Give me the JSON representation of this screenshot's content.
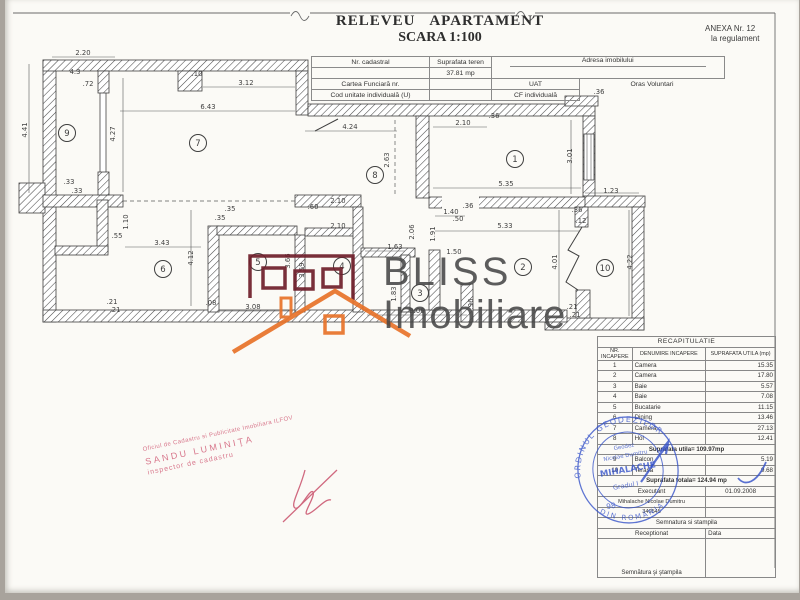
{
  "header": {
    "title1": "RELEVEU APARTAMENT",
    "title2": "SCARA 1:100",
    "anexa1": "ANEXA Nr. 12",
    "anexa2": "la regulament"
  },
  "info_table": {
    "nr_cadastral": "Nr. cadastral",
    "suprafata_teren": "Suprafata teren",
    "teren_value": "37.81 mp",
    "adresa": "Adresa imobilului",
    "cartea": "Cartea Funciară nr.",
    "uat_label": "UAT",
    "uat_value": "Oras Voluntari",
    "cod": "Cod unitate individuală (U)",
    "cf": "CF individuală"
  },
  "watermark": {
    "brand1": "BLISS",
    "brand2": "Imobiliare"
  },
  "plan": {
    "scale_note": "1:100",
    "rooms": [
      {
        "n": "1",
        "x": 510,
        "y": 159
      },
      {
        "n": "2",
        "x": 518,
        "y": 267
      },
      {
        "n": "3",
        "x": 415,
        "y": 293
      },
      {
        "n": "4",
        "x": 337,
        "y": 266
      },
      {
        "n": "5",
        "x": 253,
        "y": 262
      },
      {
        "n": "6",
        "x": 158,
        "y": 269
      },
      {
        "n": "7",
        "x": 193,
        "y": 143
      },
      {
        "n": "8",
        "x": 370,
        "y": 175
      },
      {
        "n": "9",
        "x": 62,
        "y": 133
      },
      {
        "n": "10",
        "x": 600,
        "y": 268
      }
    ],
    "dims": [
      {
        "t": "2.20",
        "x": 78,
        "y": 55
      },
      {
        "t": "4.3",
        "x": 70,
        "y": 74
      },
      {
        "t": ".72",
        "x": 83,
        "y": 86
      },
      {
        "t": "4.41",
        "x": 22,
        "y": 130,
        "v": 1
      },
      {
        "t": "4.27",
        "x": 110,
        "y": 134,
        "v": 1
      },
      {
        "t": "3.12",
        "x": 241,
        "y": 85
      },
      {
        "t": "6.43",
        "x": 203,
        "y": 109
      },
      {
        "t": ".10",
        "x": 192,
        "y": 76
      },
      {
        "t": ".33",
        "x": 64,
        "y": 184
      },
      {
        "t": ".33",
        "x": 72,
        "y": 193
      },
      {
        "t": "4.24",
        "x": 345,
        "y": 129
      },
      {
        "t": "2.63",
        "x": 384,
        "y": 160,
        "v": 1
      },
      {
        "t": "2.10",
        "x": 458,
        "y": 125
      },
      {
        "t": ".36",
        "x": 489,
        "y": 118
      },
      {
        "t": ".36",
        "x": 594,
        "y": 94
      },
      {
        "t": "5.35",
        "x": 501,
        "y": 186
      },
      {
        "t": "3.01",
        "x": 567,
        "y": 156,
        "v": 1
      },
      {
        "t": "1.23",
        "x": 606,
        "y": 193
      },
      {
        "t": ".36",
        "x": 572,
        "y": 212
      },
      {
        "t": ".12",
        "x": 576,
        "y": 223
      },
      {
        "t": "4.01",
        "x": 552,
        "y": 262,
        "v": 1
      },
      {
        "t": "4.22",
        "x": 627,
        "y": 262,
        "v": 1
      },
      {
        "t": "1.40",
        "x": 446,
        "y": 214
      },
      {
        "t": ".36",
        "x": 463,
        "y": 208
      },
      {
        "t": ".50",
        "x": 453,
        "y": 221
      },
      {
        "t": "5.33",
        "x": 500,
        "y": 228
      },
      {
        "t": "2.10",
        "x": 333,
        "y": 203
      },
      {
        "t": ".60",
        "x": 308,
        "y": 209
      },
      {
        "t": "2.10",
        "x": 333,
        "y": 228
      },
      {
        "t": ".35",
        "x": 225,
        "y": 211
      },
      {
        "t": ".35",
        "x": 215,
        "y": 220
      },
      {
        "t": "1.10",
        "x": 123,
        "y": 222,
        "v": 1
      },
      {
        "t": ".55",
        "x": 112,
        "y": 238
      },
      {
        "t": "3.43",
        "x": 157,
        "y": 245
      },
      {
        "t": "4.12",
        "x": 188,
        "y": 258,
        "v": 1
      },
      {
        "t": "1.63",
        "x": 390,
        "y": 249
      },
      {
        "t": "2.06",
        "x": 409,
        "y": 232,
        "v": 1
      },
      {
        "t": "1.91",
        "x": 430,
        "y": 234,
        "v": 1
      },
      {
        "t": "1.50",
        "x": 449,
        "y": 254
      },
      {
        "t": "1.83",
        "x": 391,
        "y": 294,
        "v": 1
      },
      {
        "t": "3.66",
        "x": 285,
        "y": 261,
        "v": 1
      },
      {
        "t": "3.59",
        "x": 299,
        "y": 270,
        "v": 1
      },
      {
        "t": "3.06",
        "x": 412,
        "y": 313
      },
      {
        "t": ".96",
        "x": 468,
        "y": 304,
        "v": 1
      },
      {
        "t": "3.08",
        "x": 248,
        "y": 309
      },
      {
        "t": ".08",
        "x": 206,
        "y": 305
      },
      {
        "t": ".21",
        "x": 107,
        "y": 304
      },
      {
        "t": ".21",
        "x": 110,
        "y": 312
      },
      {
        "t": ".21",
        "x": 567,
        "y": 309
      },
      {
        "t": ".21",
        "x": 570,
        "y": 317
      }
    ]
  },
  "recap": {
    "title": "RECAPITULATIE",
    "col_nr": "NR. INCAPERE",
    "col_den": "DENUMIRE INCAPERE",
    "col_sup": "SUPRAFATA UTILA (mp)",
    "rows": [
      {
        "nr": "1",
        "den": "Camera",
        "sup": "15.35"
      },
      {
        "nr": "2",
        "den": "Camera",
        "sup": "17.80"
      },
      {
        "nr": "3",
        "den": "Baie",
        "sup": "5.57"
      },
      {
        "nr": "4",
        "den": "Baie",
        "sup": "7.08"
      },
      {
        "nr": "5",
        "den": "Bucatarie",
        "sup": "11.15"
      },
      {
        "nr": "6",
        "den": "Dining",
        "sup": "13.46"
      },
      {
        "nr": "7",
        "den": "Camera",
        "sup": "27.13"
      },
      {
        "nr": "8",
        "den": "Hol",
        "sup": "12.41"
      }
    ],
    "utila_total": "Suprafata utila= 109.97mp",
    "rows2": [
      {
        "nr": "9",
        "den": "Balcon",
        "sup": "5.19"
      },
      {
        "nr": "10",
        "den": "Terasa",
        "sup": "9.68"
      }
    ],
    "totala": "Suprafata totala= 124.94 mp",
    "executant_label": "Executant",
    "executant_date": "01.09.2008",
    "executant_name": "Mihalache Nicolae Dumitru",
    "executant_no": "340545",
    "semnatura_stampila": "Semnatura si stampila",
    "receptionat": "Receptionat",
    "data_label": "Data",
    "semnatura_stampila2": "Semnătura şi ştampila"
  },
  "stamp_red": {
    "line1": "Oficiul de Cadastru si Publicitate Imobiliara ILFOV",
    "line2": "SANDU LUMINIŢA",
    "line3": "inspector de cadastru"
  },
  "stamp_blue": {
    "ring_top": "ORDINUL GEODEZILOR",
    "ring_bottom": "DIN ROMÂNIA",
    "inner1": "Geodez",
    "inner2": "Nicolae Dumitru",
    "name": "MIHALACHE",
    "grade": "Gradul I",
    "number": "98",
    "color": "#3350c8"
  },
  "colors": {
    "logo_dark_red": "#6f1e2b",
    "logo_orange": "#e8732a",
    "stamp_red": "#cf5671",
    "stamp_blue": "#3350c8",
    "ink": "#3f3f3f"
  }
}
